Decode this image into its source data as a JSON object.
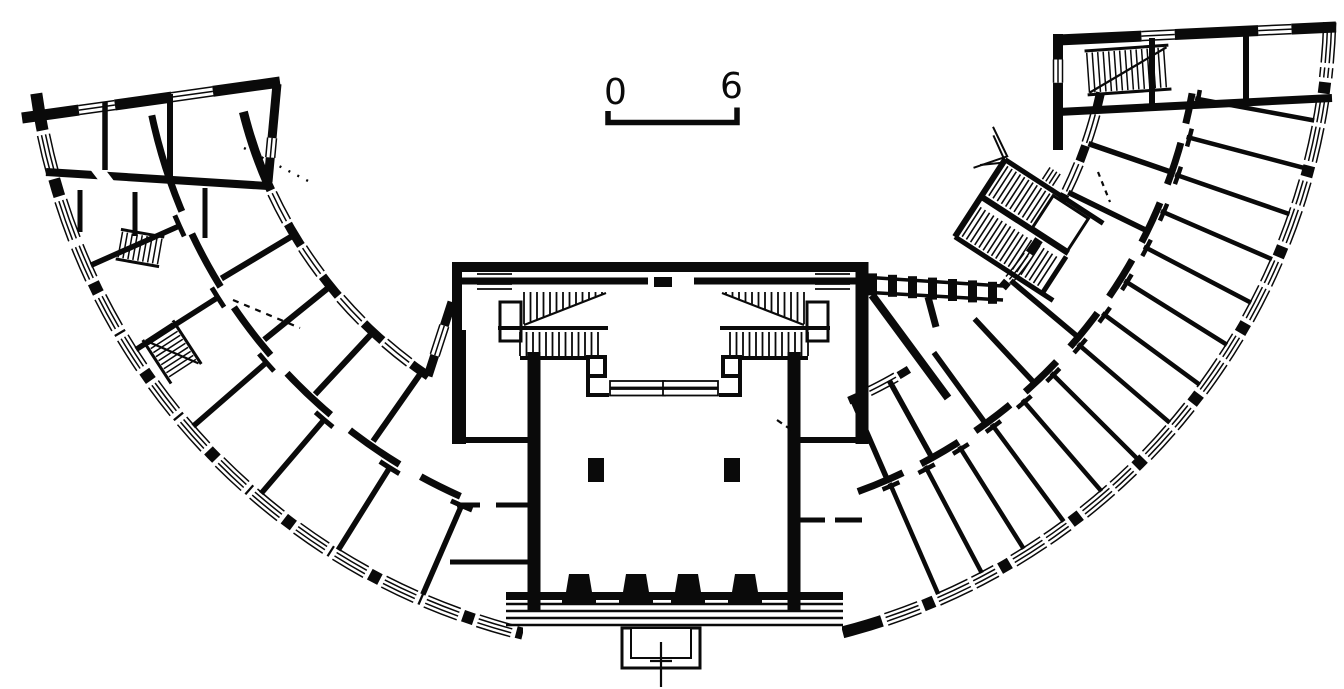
{
  "document": {
    "kind": "architectural-floor-plan",
    "style": "black-ink line drawing, scanned"
  },
  "scale_bar": {
    "start_label": "0",
    "end_label": "6"
  },
  "colors": {
    "ink": "#0a0a0a",
    "paper": "#ffffff"
  },
  "plan_elements": {
    "left_wing": "curved wing with rooms, windows and corridor",
    "right_wing": "curved wing with small rooms, arcade and dog-leg stair",
    "left_pavilion": "end pavilion with rooms and small stair",
    "right_pavilion": "end pavilion with rooms and straight stair",
    "central_block": "main hall with twin stairs, two piers, portico steps and porch"
  }
}
